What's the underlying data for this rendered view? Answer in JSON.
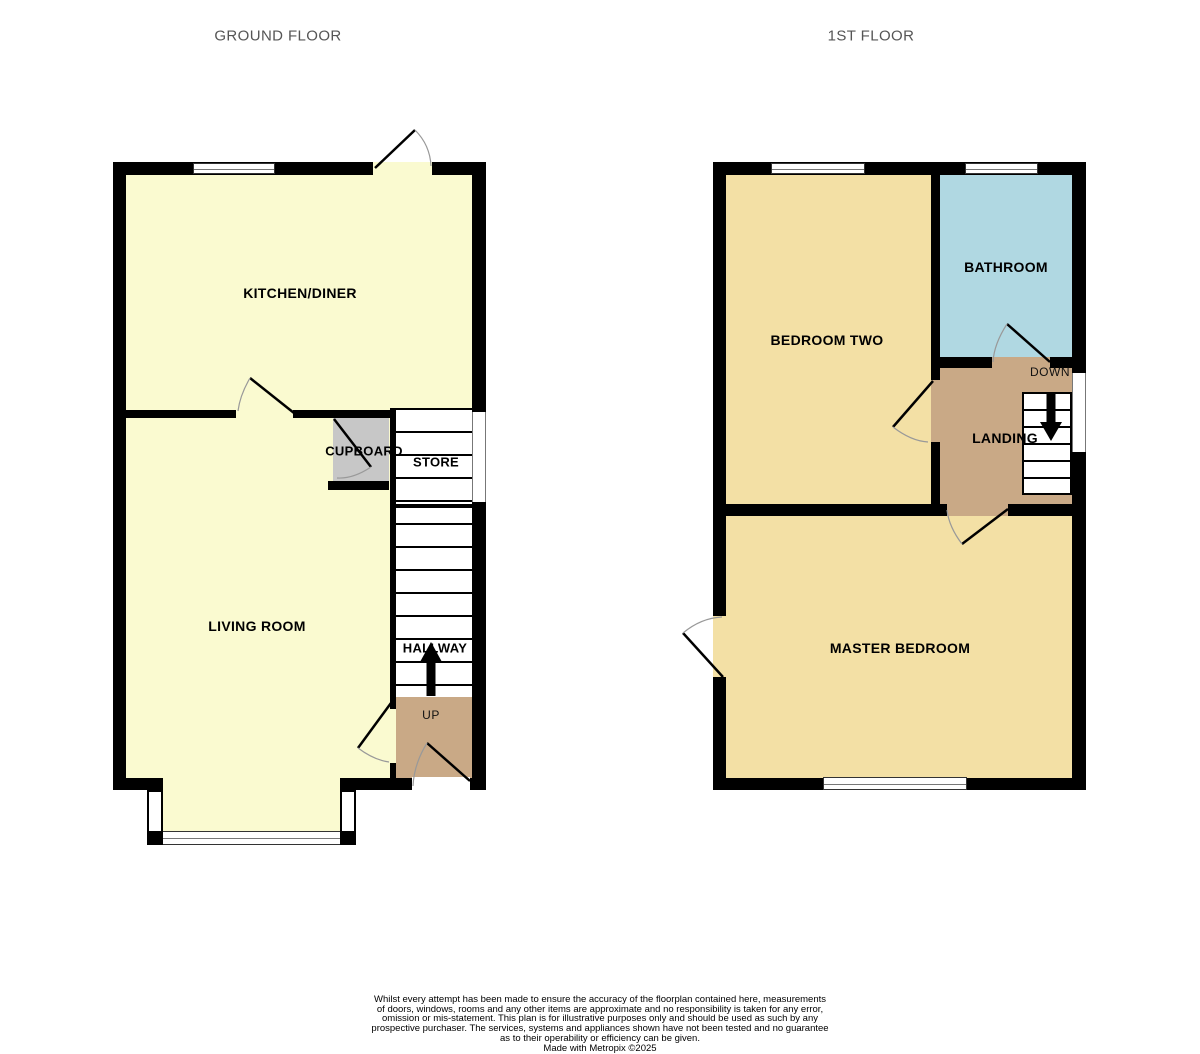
{
  "ground_floor": {
    "title": "GROUND FLOOR",
    "rooms": {
      "kitchen": "KITCHEN/DINER",
      "living": "LIVING ROOM",
      "cupboard": "CUPBOARD",
      "store": "STORE",
      "hallway": "HALLWAY",
      "up": "UP"
    }
  },
  "first_floor": {
    "title": "1ST FLOOR",
    "rooms": {
      "bedroom_two": "BEDROOM TWO",
      "bathroom": "BATHROOM",
      "landing": "LANDING",
      "master": "MASTER BEDROOM",
      "down": "DOWN"
    }
  },
  "colors": {
    "ground_room": "#FAFAD0",
    "first_room": "#F3E0A5",
    "bathroom": "#B0D8E2",
    "hall": "#C9A986",
    "cupboard": "#C7C7C7",
    "wall": "#000000",
    "title_text": "#555555"
  },
  "footer": {
    "lines": [
      "Whilst every attempt has been made to ensure the accuracy of the floorplan contained here, measurements",
      "of doors, windows, rooms and any other items are approximate and no responsibility is taken for any error,",
      "omission or mis-statement. This plan is for illustrative purposes only and should be used as such by any",
      "prospective purchaser. The services, systems and appliances shown have not been tested and no guarantee",
      "as to their operability or efficiency can be given."
    ],
    "credit": "Made with Metropix ©2025"
  }
}
